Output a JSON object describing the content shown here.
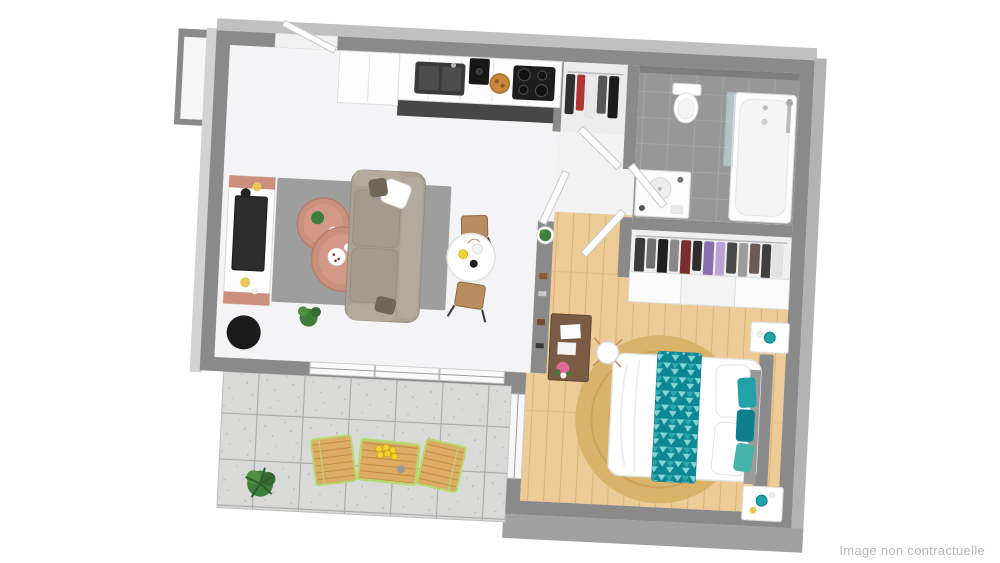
{
  "watermark": {
    "text": "Image non contractuelle",
    "color": "#b7b7b7"
  },
  "scene": {
    "kind": "3d-apartment-floor-plan-rendering",
    "rooms": [
      {
        "name": "living-room",
        "floor": "light"
      },
      {
        "name": "kitchen",
        "floor": "dark-tile-strip"
      },
      {
        "name": "entry-hall",
        "floor": "wood"
      },
      {
        "name": "bathroom",
        "floor": "grey-tile"
      },
      {
        "name": "dressing",
        "floor": "light"
      },
      {
        "name": "bedroom",
        "floor": "wood"
      },
      {
        "name": "terrace",
        "floor": "concrete-pavers"
      }
    ],
    "furniture": {
      "living_room": [
        "tv-console",
        "tv",
        "area-rug",
        "nesting-coffee-tables",
        "sofa",
        "throw-pillows",
        "round-dining-table",
        "wooden-stools",
        "floor-plant",
        "black-beanbag"
      ],
      "kitchen": [
        "counter-cabinets",
        "tall-cabinet",
        "sink",
        "coffee-machine",
        "bread-basket",
        "cooktop"
      ],
      "entry": [
        "entrance-door",
        "coat-niche-clothes",
        "shelf-unit",
        "potted-plant"
      ],
      "bathroom": [
        "toilet",
        "bathtub",
        "glass-shower-screen",
        "shower-column",
        "vanity-sink"
      ],
      "dressing": [
        "hanging-clothes-rail",
        "sliding-door-wardrobe"
      ],
      "bedroom": [
        "double-bed",
        "teal-triangle-throw",
        "teal-cushions",
        "round-jute-rug",
        "nightstand",
        "nightstand",
        "teal-lamps",
        "desk",
        "desk-chair",
        "pink-flowers",
        "window"
      ],
      "terrace": [
        "wooden-bistro-table",
        "wooden-chair",
        "wooden-chair",
        "lemons",
        "potted-plant"
      ]
    }
  },
  "palette": {
    "wall": "#8a8a8a",
    "wallOuterLeft": "#d2d2d2",
    "wallOuterTop": "#c0c0c0",
    "wallOuterRight": "#b3b3b3",
    "wallOuterBottom": "#a0a0a0",
    "floorLiving": "#f4f4f6",
    "hallEntry": "#f2f2f2",
    "floorWood": "#eccb96",
    "woodLine": "#dcb273",
    "floorTile": "#979797",
    "tileLine": "#a9a9a9",
    "paver": "#d9d9d7",
    "paverLine": "#a8a8a6",
    "kitchenDark": "#474747",
    "cabinet": "#fdfdfd",
    "applianceDark": "#1d1d1d",
    "sofa": "#aaa193",
    "sofaTrim": "#968d7f",
    "cushionDark": "#6f6658",
    "rug": "#9e9e9e",
    "terracotta": "#cb8f7e",
    "terracottaLight": "#d69a89",
    "teal": "#21a2a8",
    "tealDark": "#0f7f8e",
    "tealLight": "#86d4d8",
    "jute": "#d9b369",
    "juteLine": "#c49c52",
    "woodFurn": "#b98d5f",
    "deskWood": "#7a5c44",
    "lime": "#b5d96b",
    "plant": "#3e7d3a",
    "plantLight": "#4f9040",
    "dark": "#1b1b1b",
    "lemon": "#f0d32c",
    "pink": "#e06a95",
    "watermark": "#b7b7b7"
  }
}
